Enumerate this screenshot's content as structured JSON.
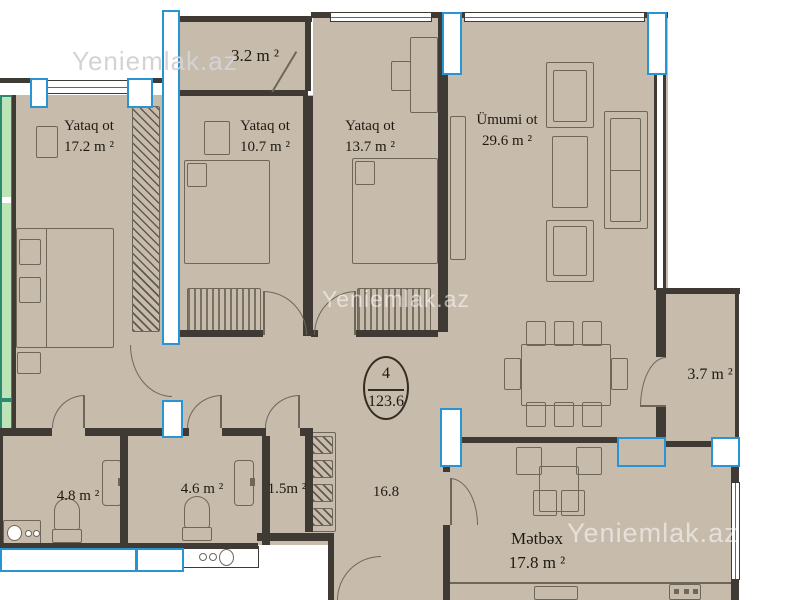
{
  "watermarks": {
    "top_left": "Yeniemlak.az",
    "center": "Yeniemlak.az",
    "bottom_right": "Yeniemlak.az"
  },
  "unit_badge": {
    "rooms_count": "4",
    "total_area": "123.6"
  },
  "rooms": [
    {
      "id": "bedroom-1",
      "name": "Yataq ot",
      "area": "17.2 m ²"
    },
    {
      "id": "bedroom-2",
      "name": "Yataq ot",
      "area": "10.7 m ²"
    },
    {
      "id": "bedroom-3",
      "name": "Yataq ot",
      "area": "13.7 m ²"
    },
    {
      "id": "living-room",
      "name": "Ümumi ot",
      "area": "29.6 m ²"
    },
    {
      "id": "balcony-top",
      "area": "3.2 m ²"
    },
    {
      "id": "balcony-right",
      "area": "3.7 m ²"
    },
    {
      "id": "bathroom",
      "area": "4.8 m ²"
    },
    {
      "id": "wc",
      "area": "4.6 m ²"
    },
    {
      "id": "closet",
      "area": "1.5m ²"
    },
    {
      "id": "hallway",
      "area": "16.8"
    },
    {
      "id": "kitchen",
      "name": "Mətbəx",
      "area": "17.8 m ²"
    }
  ],
  "colors": {
    "floor_fill": "#c7bbac",
    "wall": "#3f3a33",
    "window_frame_blue": "#2994d4",
    "balcony_green": "#bce4b6",
    "watermark_gray": "#d3d3d3"
  }
}
